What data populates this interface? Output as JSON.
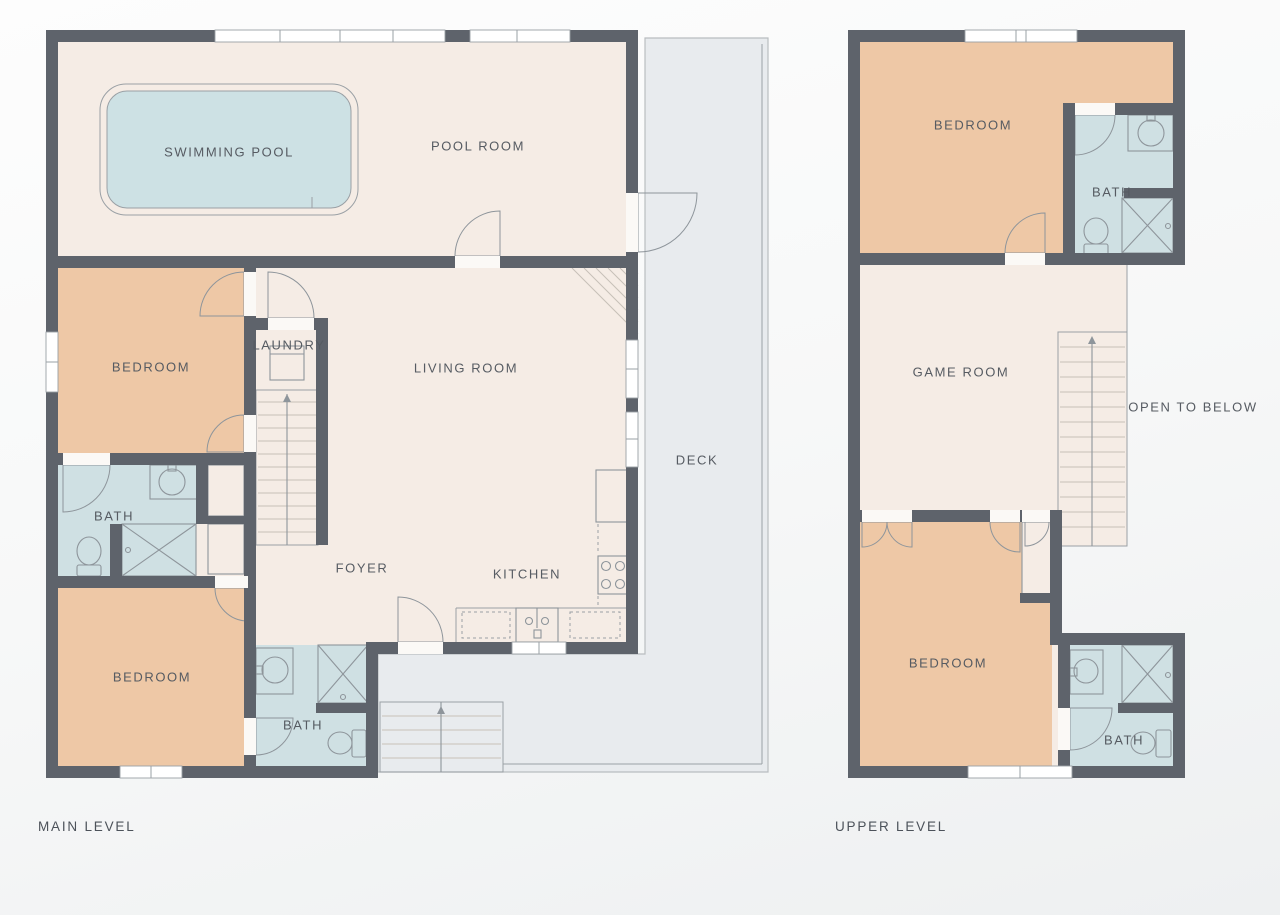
{
  "palette": {
    "wall": "#5e636b",
    "floor": "#f5ece5",
    "bedroom": "#eec8a6",
    "bath": "#cfe0e3",
    "pool": "#cde1e4",
    "deck": "#e8ebee",
    "deck-edge": "#b9bdc0",
    "line": "#9aa0a5",
    "fixture": "#8e959b",
    "tread": "#c7c0b8",
    "opening": "#fbf9f6",
    "text": "#565b62",
    "title": "#4c525a"
  },
  "main_level": {
    "title": "MAIN LEVEL",
    "rooms": {
      "swimming_pool": "SWIMMING POOL",
      "pool_room": "POOL ROOM",
      "bedroom_top": "BEDROOM",
      "laundry": "LAUNDRY",
      "living_room": "LIVING ROOM",
      "deck": "DECK",
      "bath_left": "BATH",
      "foyer": "FOYER",
      "kitchen": "KITCHEN",
      "bedroom_bottom": "BEDROOM",
      "bath_bottom": "BATH"
    }
  },
  "upper_level": {
    "title": "UPPER LEVEL",
    "rooms": {
      "bedroom_top": "BEDROOM",
      "bath_top": "BATH",
      "game_room": "GAME ROOM",
      "open_to_below": "OPEN TO BELOW",
      "bedroom_bottom": "BEDROOM",
      "bath_bottom": "BATH"
    }
  }
}
